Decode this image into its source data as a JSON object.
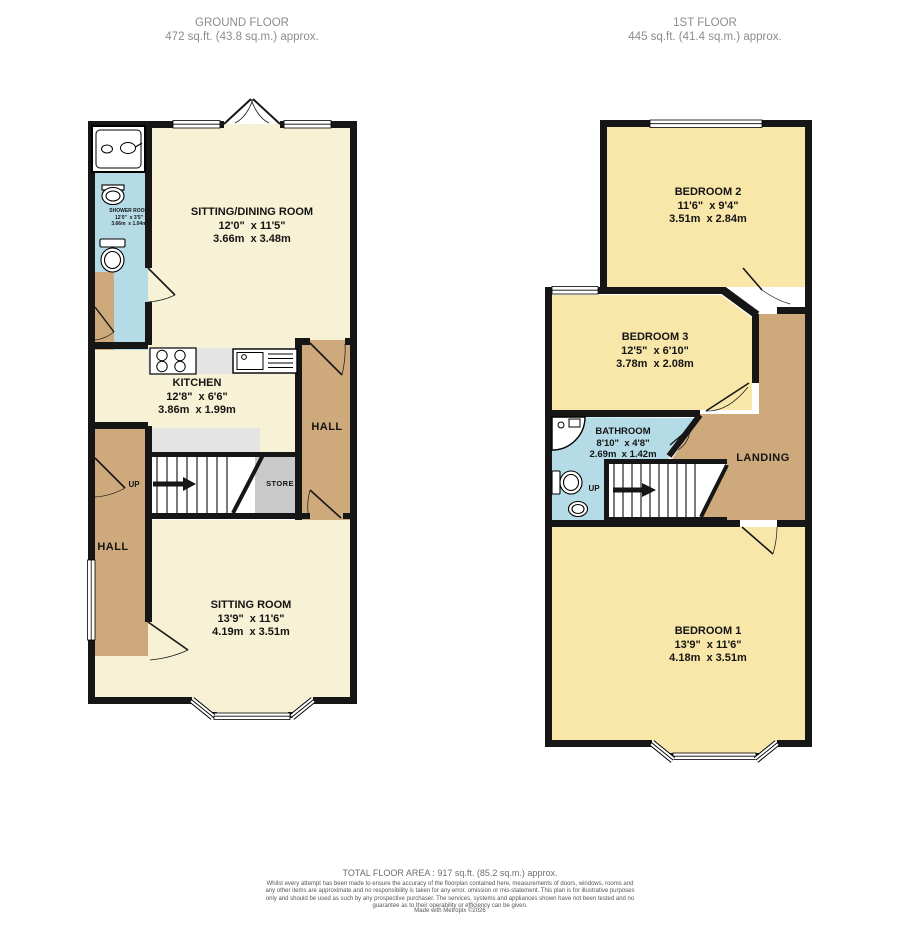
{
  "ground_floor": {
    "header": {
      "title": "GROUND FLOOR",
      "area": "472 sq.ft. (43.8 sq.m.) approx."
    },
    "shower_room": {
      "name": "SHOWER ROOM",
      "imperial": "12'0\"  x 3'5\"",
      "metric": "3.66m  x 1.04m"
    },
    "sitting_dining_room": {
      "name": "SITTING/DINING ROOM",
      "imperial": "12'0\"  x 11'5\"",
      "metric": "3.66m  x 3.48m"
    },
    "kitchen": {
      "name": "KITCHEN",
      "imperial": "12'8\"  x 6'6\"",
      "metric": "3.86m  x 1.99m"
    },
    "hall_right": {
      "name": "HALL"
    },
    "hall_left": {
      "name": "HALL"
    },
    "store": {
      "name": "STORE"
    },
    "stairs": {
      "label": "UP"
    },
    "sitting_room": {
      "name": "SITTING ROOM",
      "imperial": "13'9\"  x 11'6\"",
      "metric": "4.19m  x 3.51m"
    }
  },
  "first_floor": {
    "header": {
      "title": "1ST FLOOR",
      "area": "445 sq.ft. (41.4 sq.m.) approx."
    },
    "bedroom2": {
      "name": "BEDROOM 2",
      "imperial": "11'6\"  x 9'4\"",
      "metric": "3.51m  x 2.84m"
    },
    "bedroom3": {
      "name": "BEDROOM 3",
      "imperial": "12'5\"  x 6'10\"",
      "metric": "3.78m  x 2.08m"
    },
    "bathroom": {
      "name": "BATHROOM",
      "imperial": "8'10\"  x 4'8\"",
      "metric": "2.69m  x 1.42m"
    },
    "landing": {
      "name": "LANDING"
    },
    "stairs": {
      "label": "UP"
    },
    "bedroom1": {
      "name": "BEDROOM 1",
      "imperial": "13'9\"  x 11'6\"",
      "metric": "4.18m  x 3.51m"
    }
  },
  "footer": {
    "total_area": "TOTAL FLOOR AREA : 917 sq.ft. (85.2 sq.m.) approx.",
    "disclaimer": "Whilst every attempt has been made to ensure the accuracy of the floorplan contained here, measurements of doors, windows, rooms and any other items are approximate and no responsibility is taken for any error, omission or mis-statement. This plan is for illustrative purposes only and should be used as such by any prospective purchaser. The services, systems and appliances shown have not been tested and no guarantee as to their operability or efficiency can be given.",
    "credit": "Made with Metropix ©2026"
  },
  "colors": {
    "room_cream": "#f7f1d6",
    "room_yellow": "#f9e7a9",
    "hall_tan": "#cda97c",
    "wet_blue": "#b5dce6",
    "store_gray": "#c9c9c9",
    "counter_gray": "#e4e4e4",
    "wall": "#161616"
  }
}
